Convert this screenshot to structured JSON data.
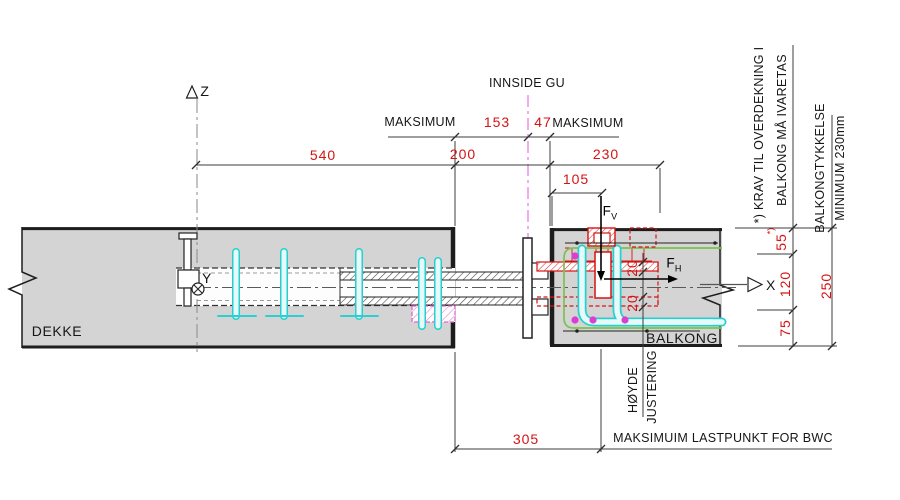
{
  "labels": {
    "innside_gu": "INNSIDE GU",
    "maksimum_left": "MAKSIMUM",
    "maksimum_right": "MAKSIMUM",
    "dekke": "DEKKE",
    "balkong": "BALKONG",
    "hoyde": "HØYDE",
    "justering": "JUSTERING",
    "lastpunkt": "MAKSIMUIM LASTPUNKT FOR BWC",
    "note_line1": "*) KRAV TIL OVERDEKNING I",
    "note_line2": "BALKONG MÅ IVARETAS",
    "tykkelse_line1": "BALKONGTYKKELSE",
    "tykkelse_line2": "MINIMUM 230mm",
    "star_ref": "*)"
  },
  "axes": {
    "z": "Z",
    "y": "Y",
    "x": "X"
  },
  "forces": {
    "fv_main": "F",
    "fv_sub": "V",
    "fh_main": "F",
    "fh_sub": "H"
  },
  "dims": {
    "d540": "540",
    "d153": "153",
    "d47": "47",
    "d200": "200",
    "d230": "230",
    "d105": "105",
    "d20_top": "20",
    "d20_bot": "20",
    "d55": "55",
    "d120": "120",
    "d75": "75",
    "d250": "250",
    "d305": "305"
  },
  "colors": {
    "dim_red": "#d41414",
    "rebar_cyan": "#29cfcf",
    "cover_green": "#7cc24e",
    "magenta": "#da3fd0",
    "slab_gray": "#d4d4d4",
    "line_dark": "#1d1d1d"
  }
}
